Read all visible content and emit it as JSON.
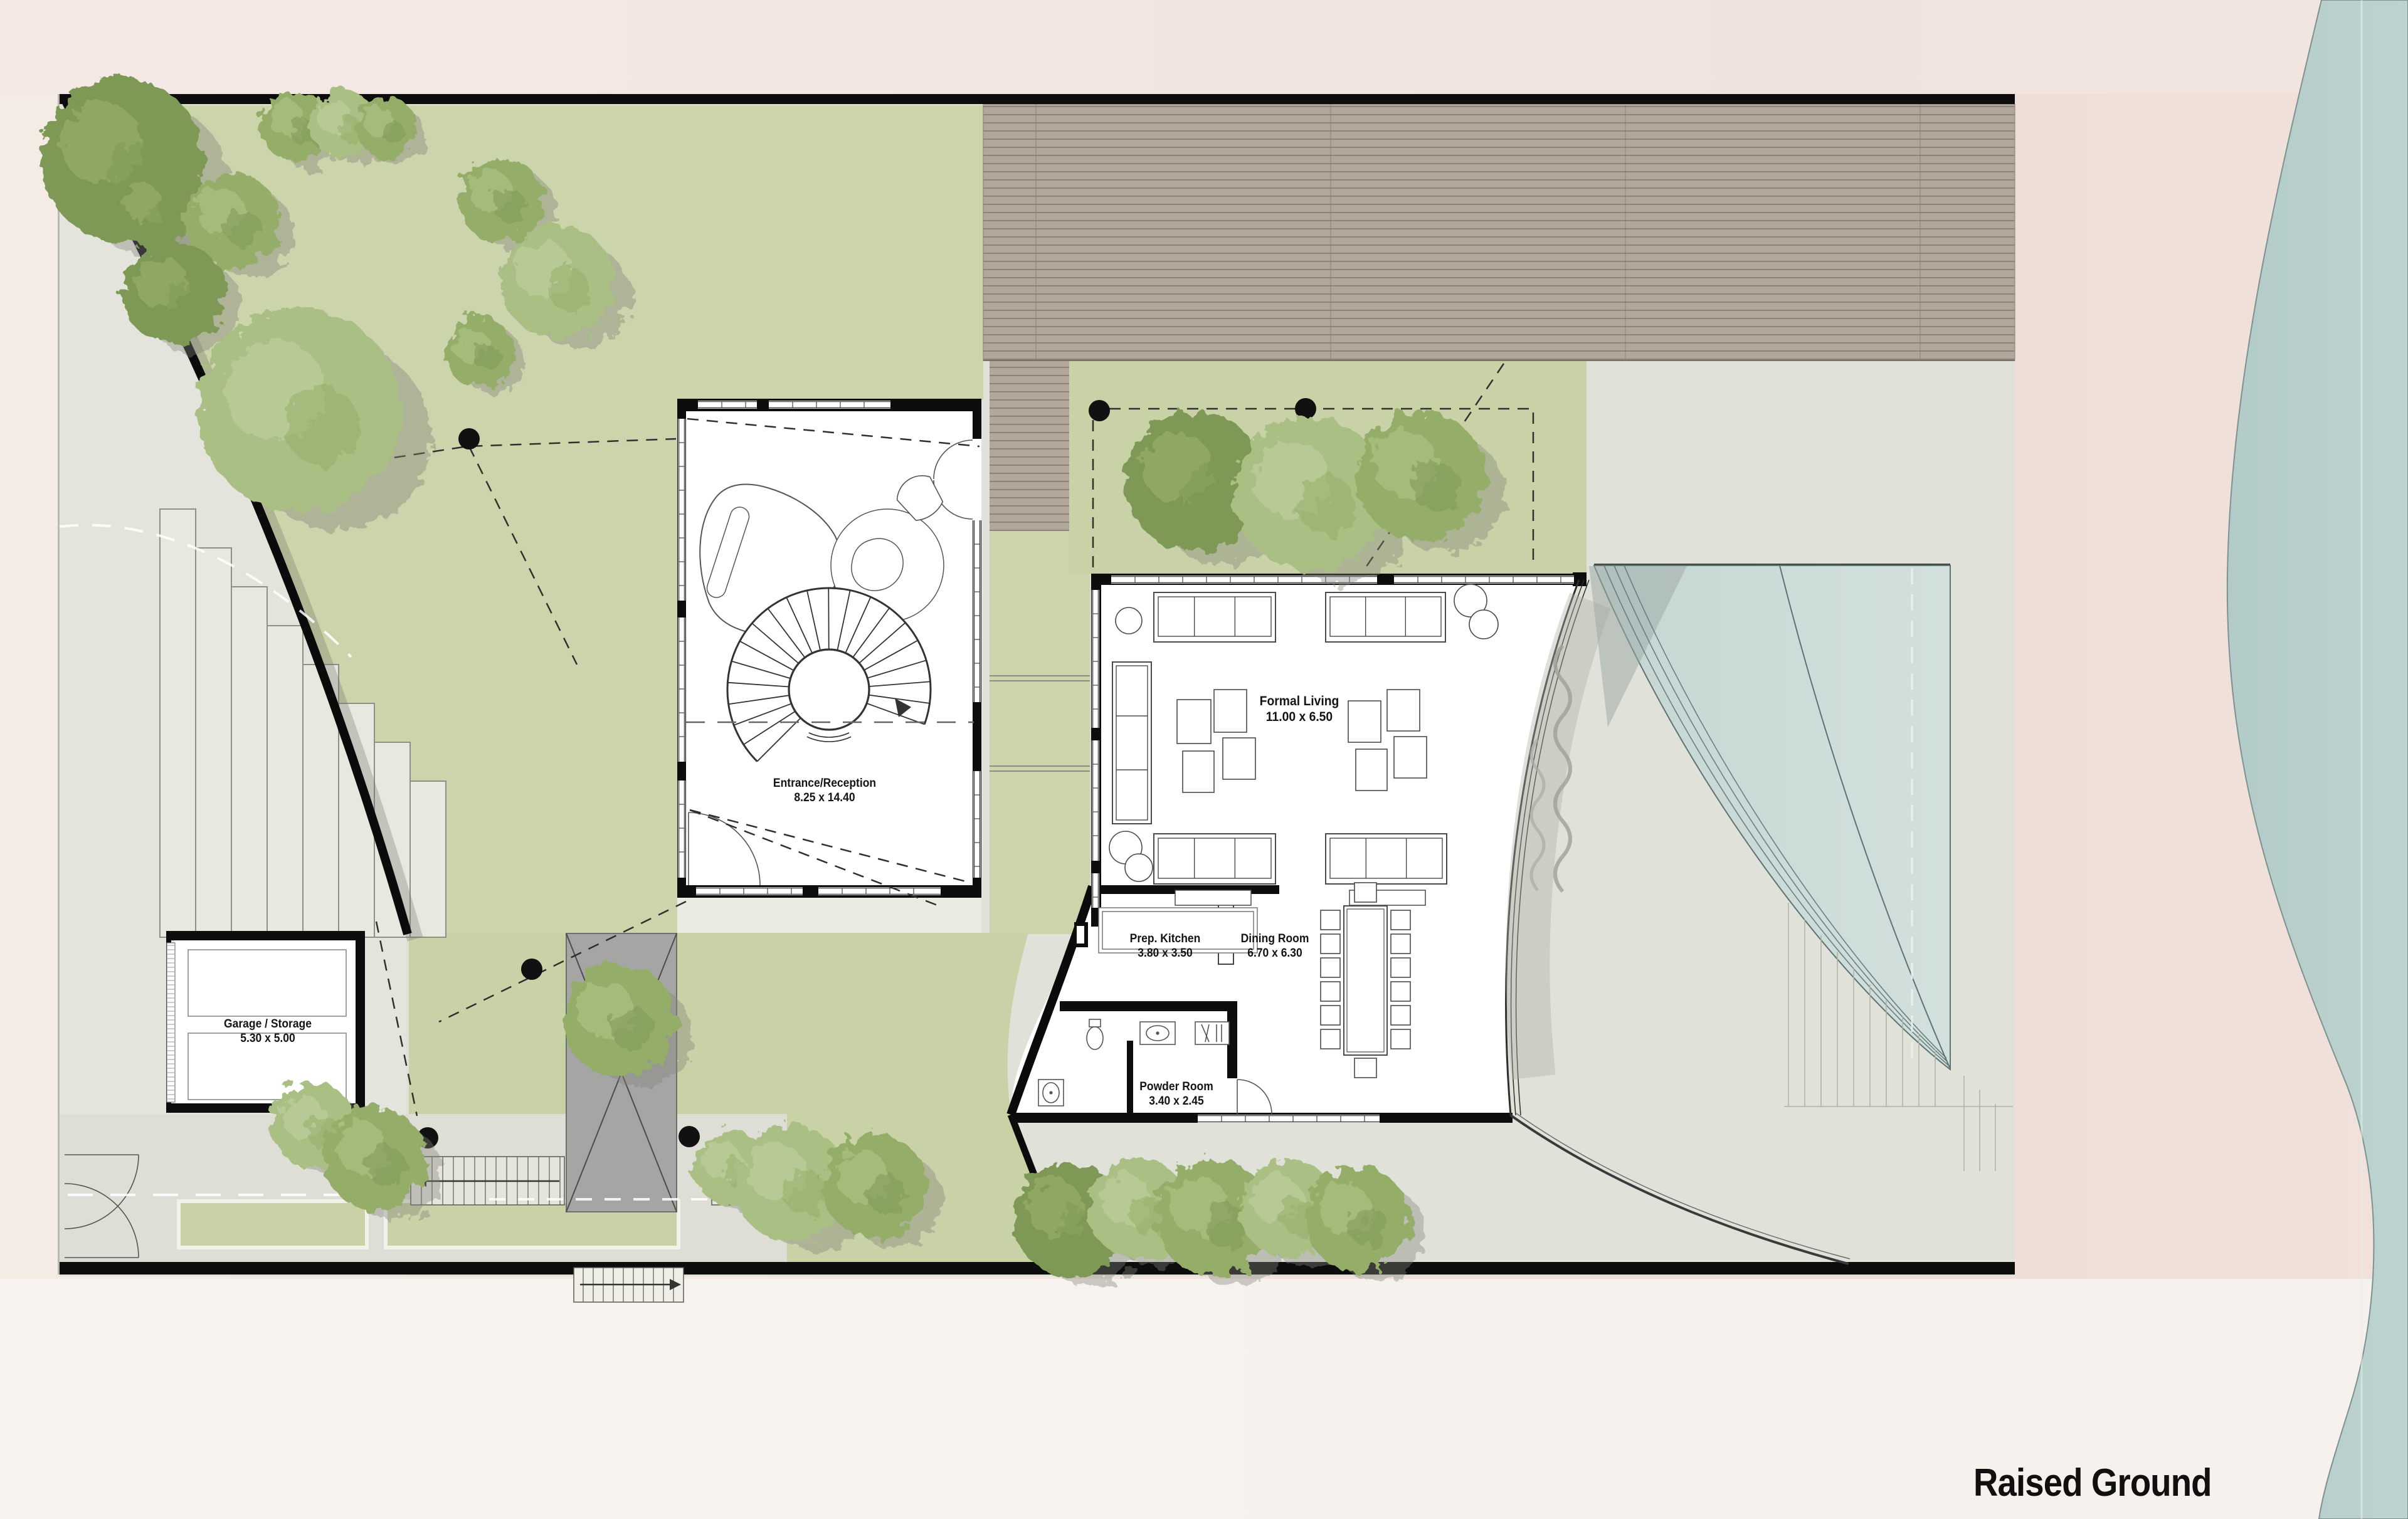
{
  "title": "Raised Ground",
  "rooms": [
    {
      "id": "entrance",
      "name": "Entrance/Reception",
      "dims": "8.25 x 14.40"
    },
    {
      "id": "formal-living",
      "name": "Formal Living",
      "dims": "11.00 x 6.50"
    },
    {
      "id": "prep-kitchen",
      "name": "Prep. Kitchen",
      "dims": "3.80 x 3.50"
    },
    {
      "id": "dining-room",
      "name": "Dining Room",
      "dims": "6.70 x 6.30"
    },
    {
      "id": "powder-room",
      "name": "Powder Room",
      "dims": "3.40 x 2.45"
    },
    {
      "id": "garage",
      "name": "Garage / Storage",
      "dims": "5.30 x 5.00"
    }
  ],
  "palette": {
    "sand": "#f3e6e0",
    "sea": "#b7cecb",
    "lawn": "#cbd4aa",
    "paving": "#e0e1d9",
    "deck": "#b2a79b",
    "pool": "#c9dad6",
    "wall": "#0d0d0d",
    "canopy_shed": "#a5a5a3",
    "tree_dark": "#7d9955",
    "tree_mid": "#94ae69",
    "tree_light": "#a9bf83"
  }
}
